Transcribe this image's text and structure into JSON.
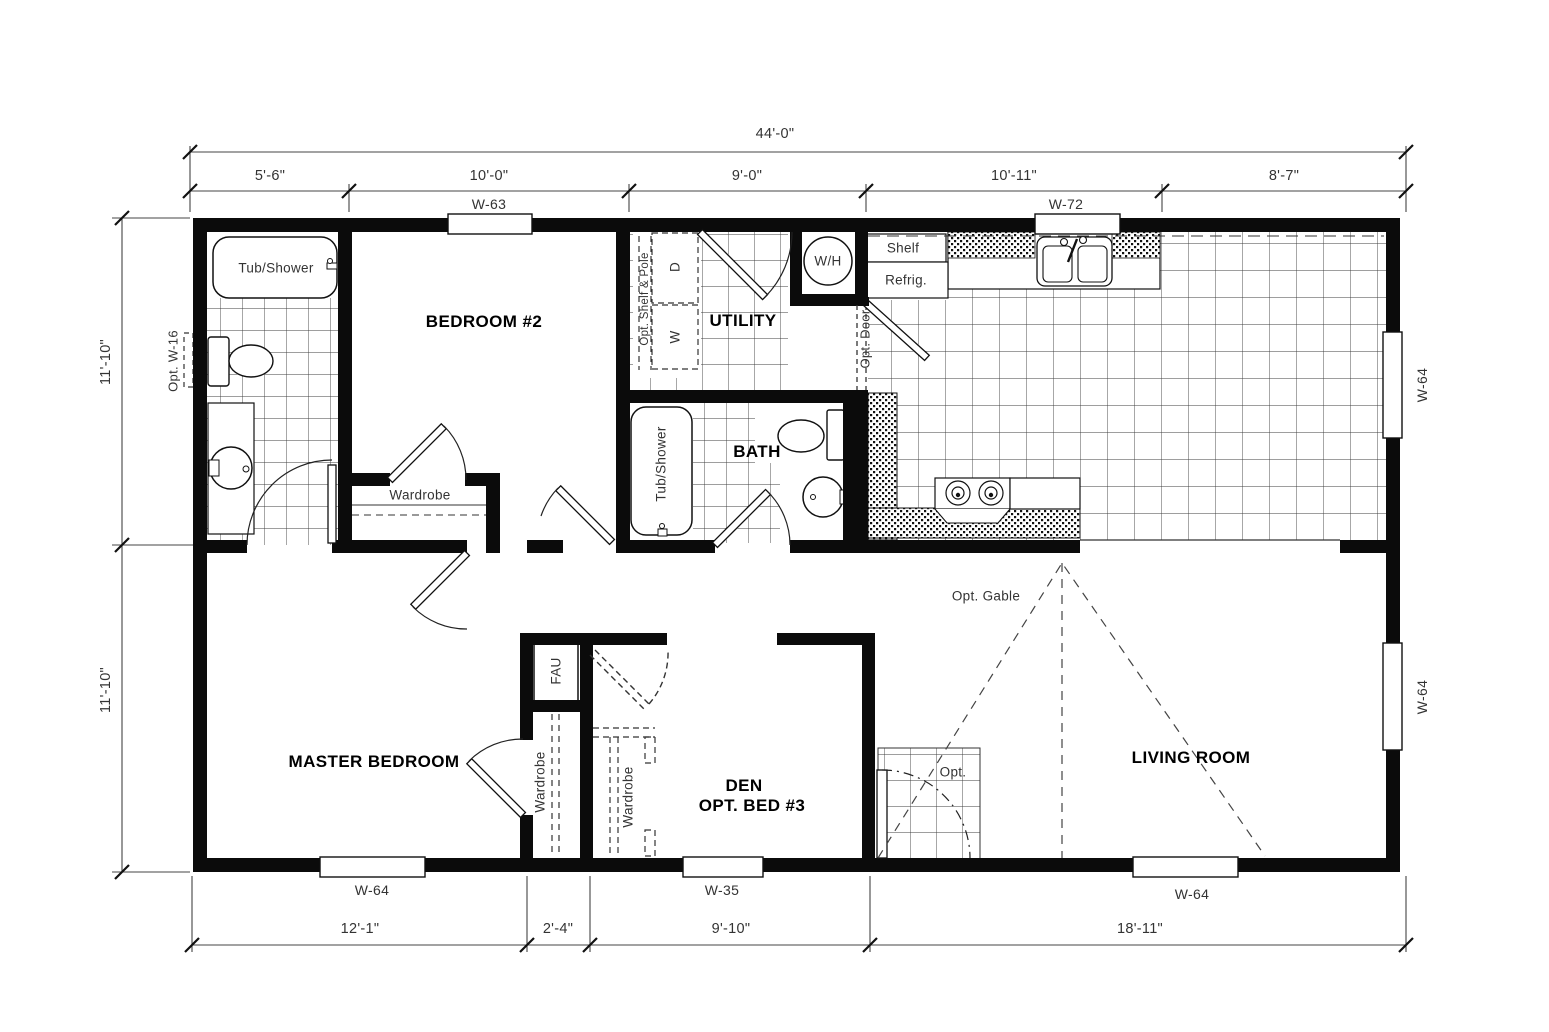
{
  "dimensions": {
    "top_total": "44'-0\"",
    "top_segments": [
      "5'-6\"",
      "10'-0\"",
      "9'-0\"",
      "10'-11\"",
      "8'-7\""
    ],
    "left_upper": "11'-10\"",
    "left_lower": "11'-10\"",
    "bottom_segments": [
      "12'-1\"",
      "2'-4\"",
      "9'-10\"",
      "18'-11\""
    ]
  },
  "windows": {
    "w63": "W-63",
    "w72": "W-72",
    "w64_right_top": "W-64",
    "w64_right_bottom": "W-64",
    "w64_master": "W-64",
    "w35_den": "W-35",
    "w64_living": "W-64",
    "opt_w16": "Opt. W-16"
  },
  "rooms": {
    "bedroom2": "BEDROOM #2",
    "utility": "UTILITY",
    "bath": "BATH",
    "master": "MASTER BEDROOM",
    "den_line1": "DEN",
    "den_line2": "OPT. BED #3",
    "living": "LIVING ROOM"
  },
  "fixtures": {
    "tub_shower_main": "Tub/Shower",
    "tub_shower_hall": "Tub/Shower",
    "wardrobe_bed2": "Wardrobe",
    "wardrobe_master": "Wardrobe",
    "wardrobe_den": "Wardrobe",
    "opt_shelf_pole": "Opt. Shelf & Pole",
    "dryer": "D",
    "washer": "W",
    "water_heater": "W/H",
    "shelf": "Shelf",
    "refrigerator": "Refrig.",
    "opt_door": "Opt. Door",
    "fau": "FAU",
    "opt_gable": "Opt. Gable",
    "opt_entry": "Opt."
  }
}
